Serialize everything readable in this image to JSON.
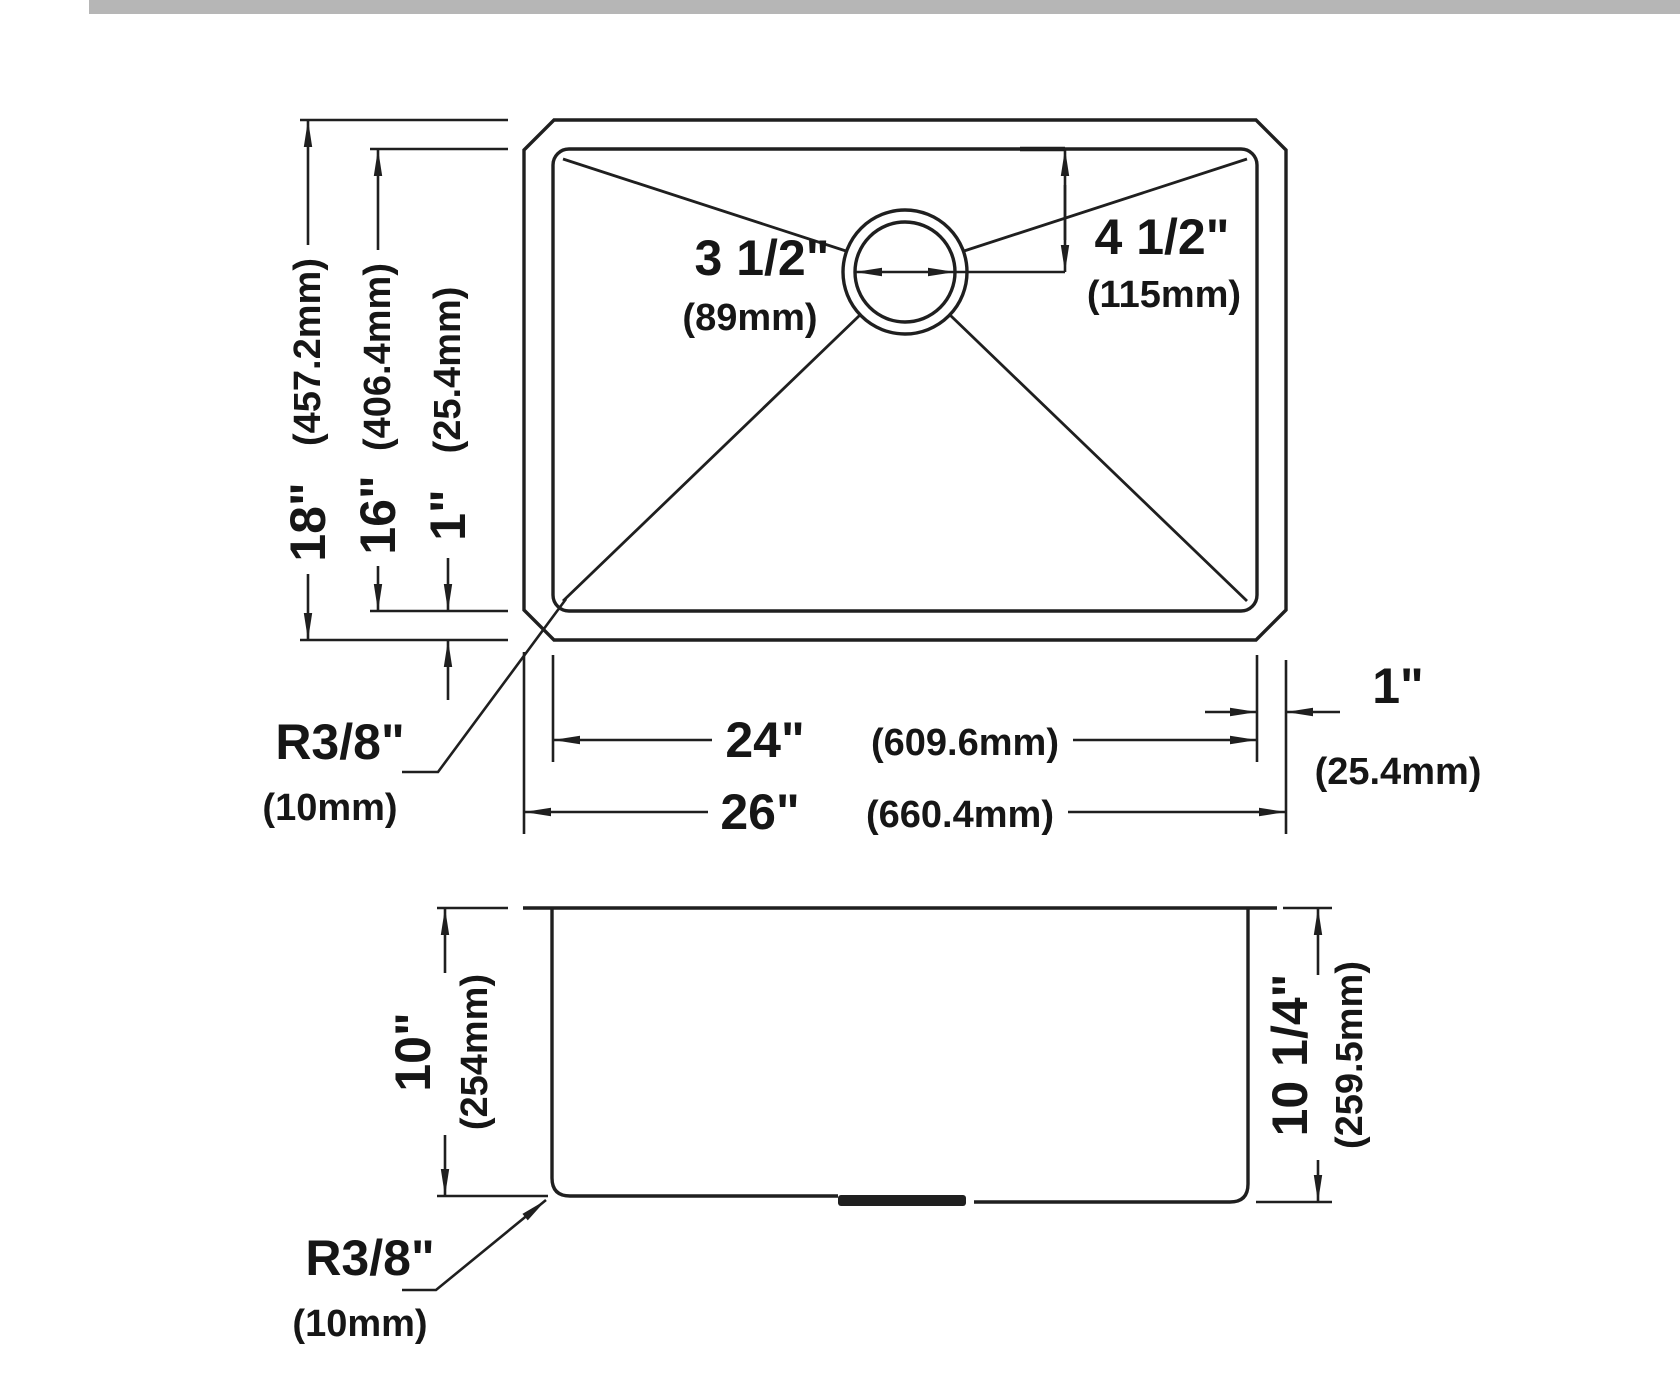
{
  "colors": {
    "background": "#ffffff",
    "line": "#1f1f1f",
    "text": "#161616",
    "topbar": "#b6b6b6"
  },
  "top_view": {
    "height_outer": {
      "inches": "18\"",
      "mm": "(457.2mm)"
    },
    "height_inner": {
      "inches": "16\"",
      "mm": "(406.4mm)"
    },
    "rim_bottom": {
      "inches": "1\"",
      "mm": "(25.4mm)"
    },
    "drain_diameter": {
      "inches": "3 1/2\"",
      "mm": "(89mm)"
    },
    "drain_offset": {
      "inches": "4 1/2\"",
      "mm": "(115mm)"
    },
    "width_inner": {
      "inches": "24\"",
      "mm": "(609.6mm)"
    },
    "width_outer": {
      "inches": "26\"",
      "mm": "(660.4mm)"
    },
    "rim_right": {
      "inches": "1\"",
      "mm": "(25.4mm)"
    },
    "corner_radius": {
      "inches": "R3/8\"",
      "mm": "(10mm)"
    }
  },
  "side_view": {
    "depth_left": {
      "inches": "10\"",
      "mm": "(254mm)"
    },
    "depth_right": {
      "inches": "10 1/4\"",
      "mm": "(259.5mm)"
    },
    "corner_radius": {
      "inches": "R3/8\"",
      "mm": "(10mm)"
    }
  }
}
